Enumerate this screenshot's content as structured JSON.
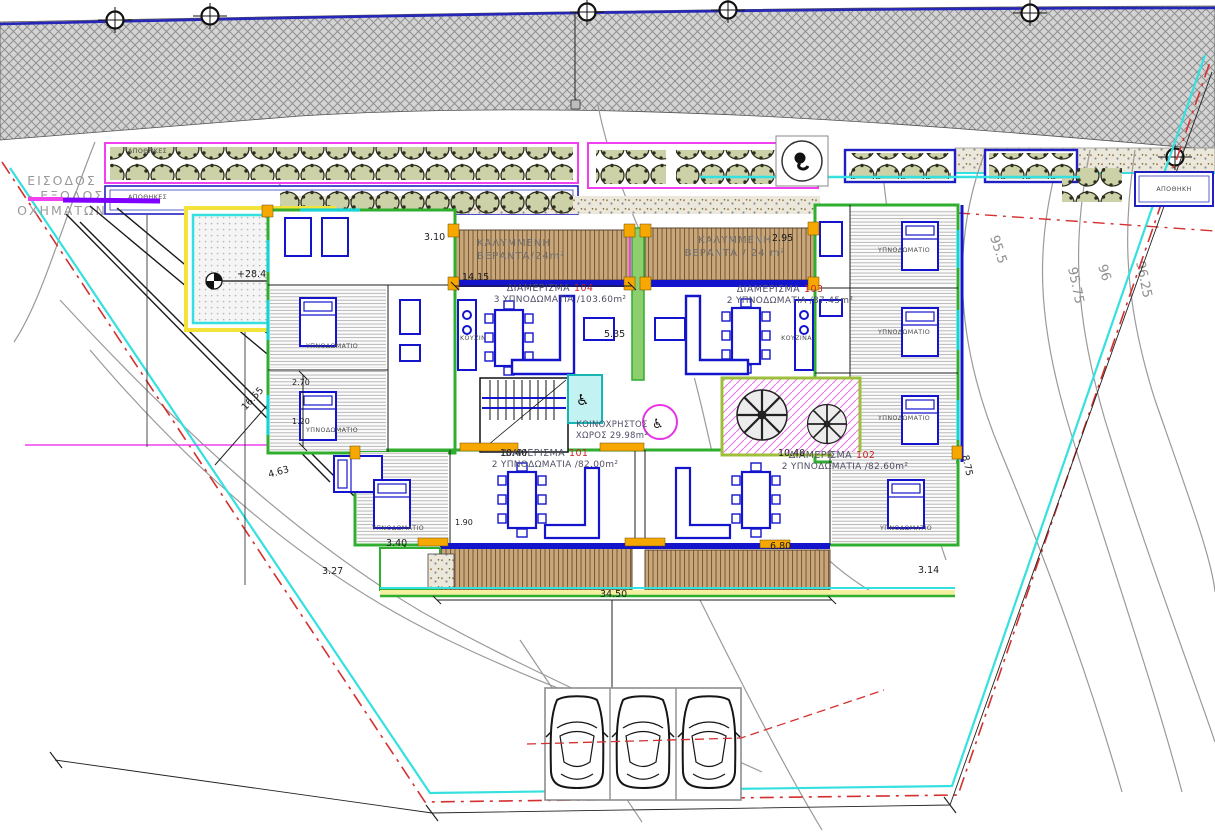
{
  "labels": {
    "entrance_line1": "ΕΙΣΟΔΟΣ",
    "entrance_line2": "- ΕΞΟΔΟΣ",
    "entrance_line3": "ΟΧΗΜΑΤΩΝ",
    "veranda_left_line1": "ΚΑΛΥΜΜΕΝΗ",
    "veranda_left_line2": "ΒΕΡΑΝΤΑ/24m²",
    "veranda_right_line1": "ΚΑΛΥΜΜΕΝΗ",
    "veranda_right_line2": "ΒΕΡΑΝΤΑ / 24 m²",
    "communal_line1": "ΚΟΙΝΟΧΡΗΣΤΟΣ",
    "communal_line2": "ΧΩΡΟΣ 29.98m²",
    "bedroom": "ΥΠΝΟΔΩΜΑΤΙΟ",
    "kitchen": "ΚΟΥΖΙΝΑ",
    "storage_left": "ΑΠΟΘΗΚΕΣ",
    "storage_right": "ΑΠΟΘΗΚΗ"
  },
  "apartments": [
    {
      "label": "ΔΙΑΜΕΡΙΣΜΑ",
      "number": "104",
      "details": "3 ΥΠΝΟΔΩΜΑΤΙΑ /103.60m²"
    },
    {
      "label": "ΔΙΑΜΕΡΙΣΜΑ",
      "number": "103",
      "details": "2 ΥΠΝΟΔΩΜΑΤΙΑ /87.45m²"
    },
    {
      "label": "ΔΙΑΜΕΡΙΣΜΑ",
      "number": "101",
      "details": "2 ΥΠΝΟΔΩΜΑΤΙΑ /82.00m²"
    },
    {
      "label": "ΔΙΑΜΕΡΙΣΜΑ",
      "number": "102",
      "details": "2 ΥΠΝΟΔΩΜΑΤΙΑ /82.60m²"
    }
  ],
  "levels": {
    "pool_spot": "+28.45"
  },
  "contour_labels": [
    "95.5",
    "95.75",
    "96",
    "96.25",
    "95"
  ],
  "dimensions": {
    "d1415": "14.15",
    "d535": "5.35",
    "d310": "3.10",
    "d295": "2.95",
    "d1655": "16.55",
    "d463": "4.63",
    "d327": "3.27",
    "d340": "3.40",
    "d190": "1.90",
    "d1040a": "10.40",
    "d1040b": "10.40",
    "d3450": "34.50",
    "d680": "6.80",
    "d314": "3.14",
    "d875": "8.75",
    "d270": "2.70",
    "d120": "1.20"
  },
  "icons": {
    "wheelchair": "♿"
  },
  "colors": {
    "wall_green": "#2fae2f",
    "wall_cyan": "#19d3d3",
    "accent_orange": "#f6a800",
    "furniture_blue": "#1414cc",
    "boundary_cyan": "#35e0e0",
    "boundary_red": "#d43030",
    "magenta": "#f040f0",
    "deck_brown": "#c9a87a",
    "road_blue": "#2626b8"
  }
}
